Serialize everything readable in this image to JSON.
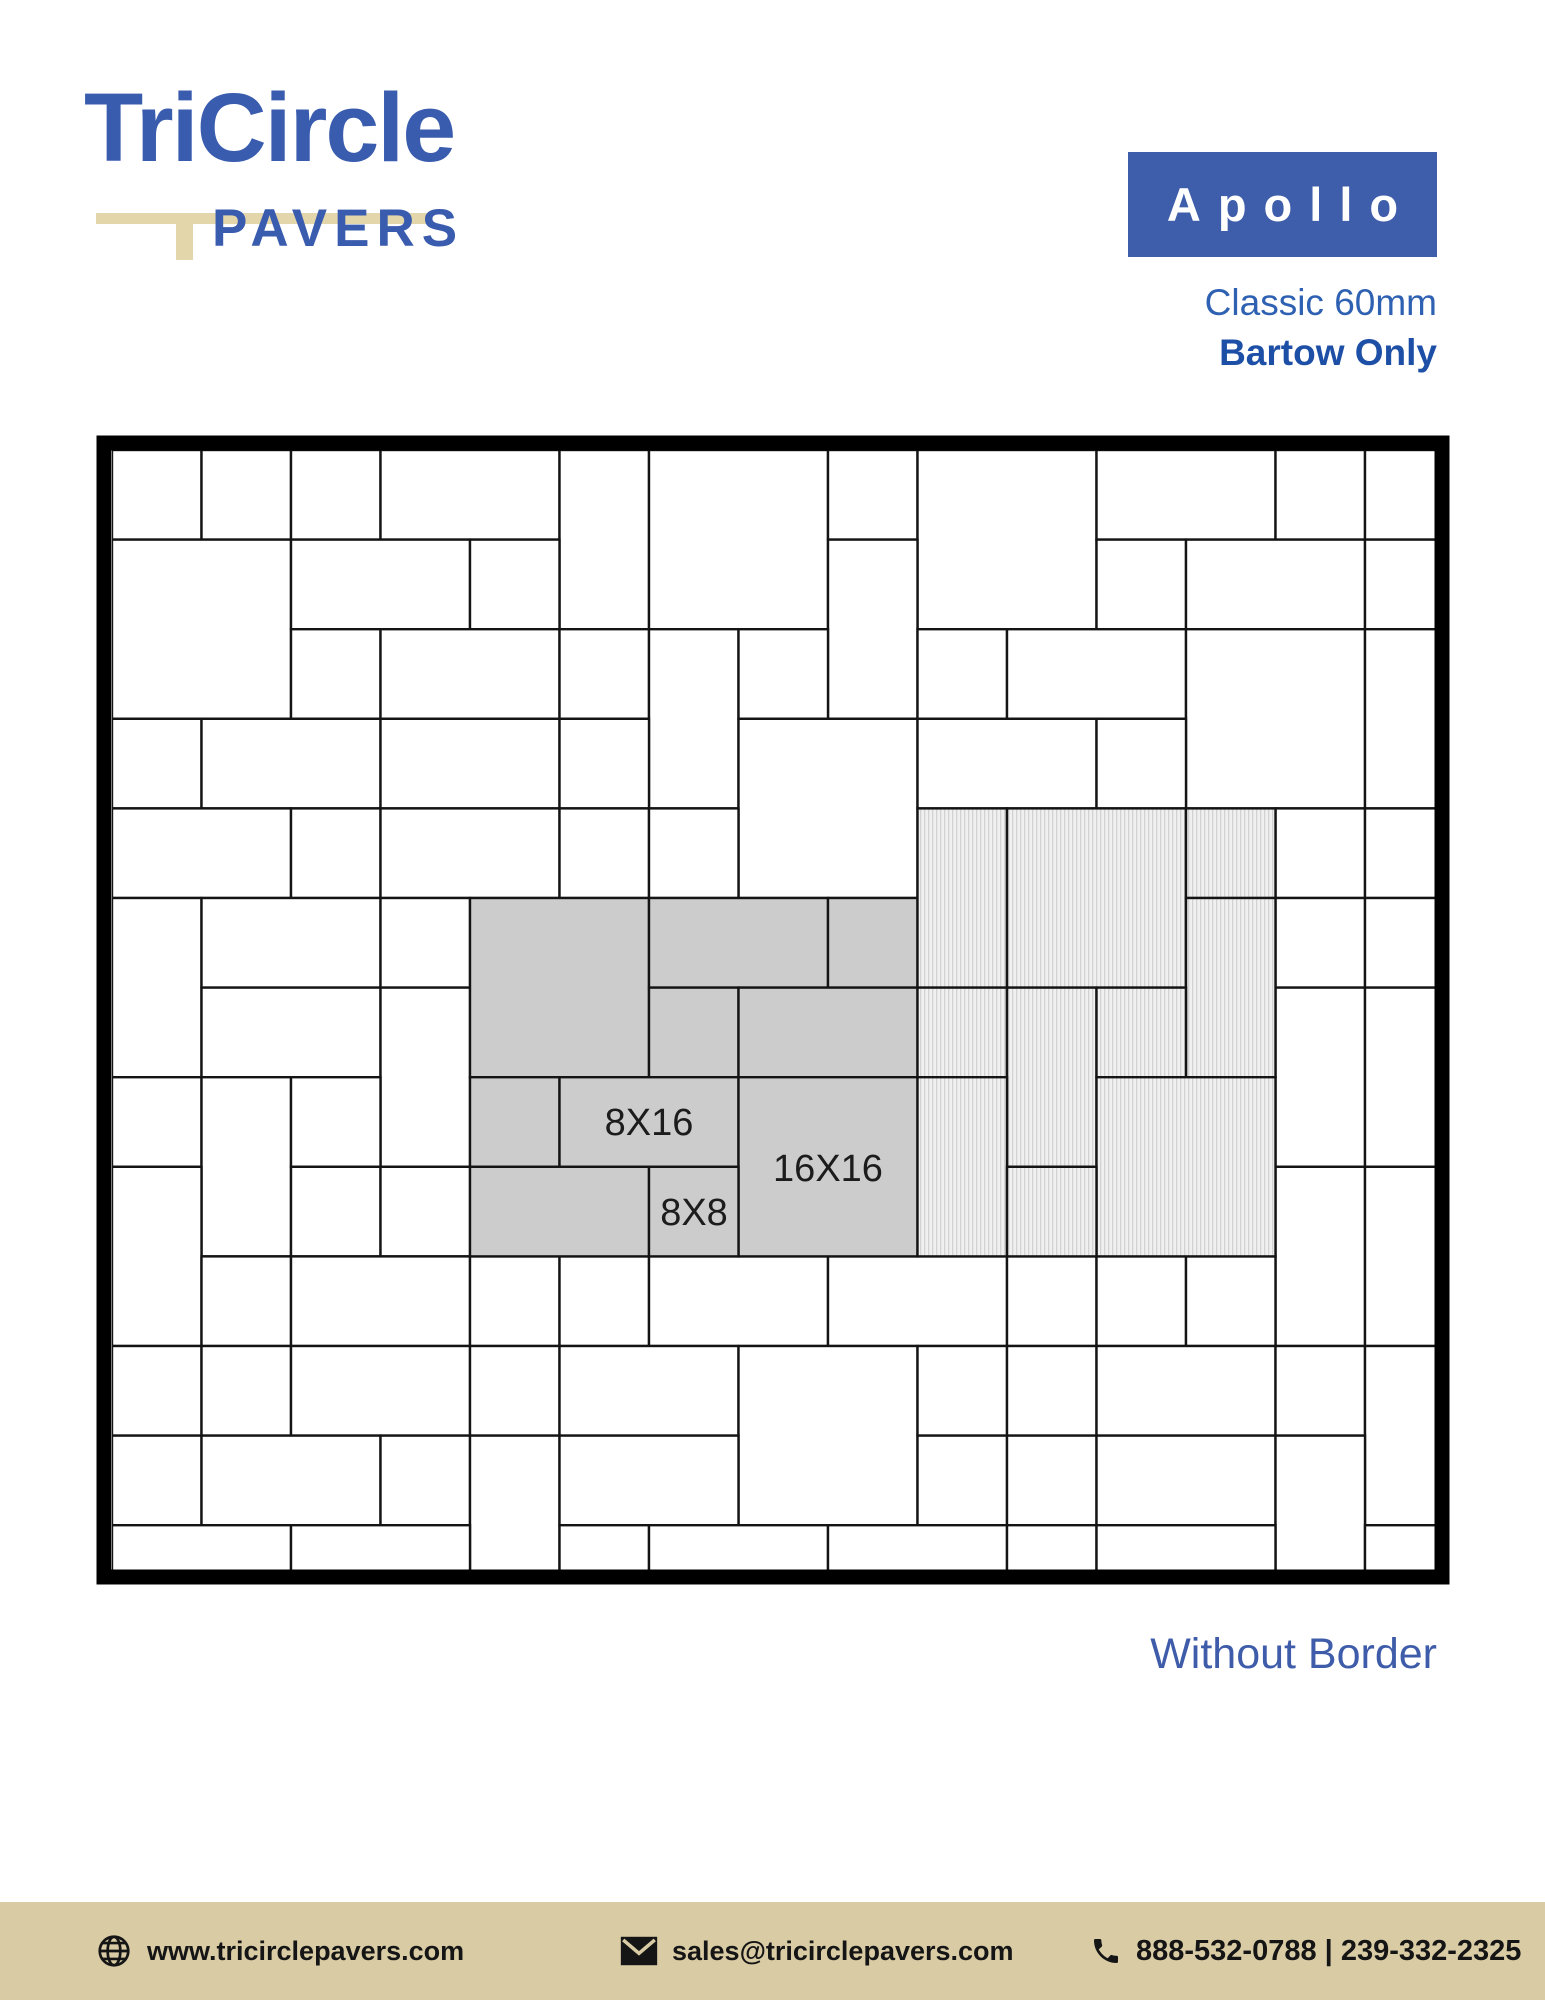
{
  "logo": {
    "title": "TriCircle",
    "subtitle": "PAVERS"
  },
  "product": {
    "name": "Apollo",
    "line1": "Classic 60mm",
    "line2": "Bartow Only"
  },
  "caption": "Without Border",
  "footer": {
    "website": "www.tricirclepavers.com",
    "email": "sales@tricirclepavers.com",
    "phone": "888-532-0788 | 239-332-2325"
  },
  "colors": {
    "brand_blue": "#3A5CAE",
    "badge_blue": "#3E5DAA",
    "classic_blue": "#2F61B2",
    "bartow_blue": "#1C4FA5",
    "caption_blue": "#3E5CA9",
    "tan": "#E3D6AB",
    "footer_tan": "#D9CCA5",
    "tile_white": "#ffffff",
    "tile_gray": "#cccccc",
    "hatch_base": "#f0f0f0",
    "hatch_line": "#d2d2d2",
    "line_black": "#141414"
  },
  "diagram": {
    "frame": {
      "x": 104,
      "y": 443,
      "w": 1338,
      "h": 1134,
      "stroke": 15
    },
    "grid": {
      "origin_x": 112,
      "origin_y": 450,
      "unit_x": 89.5,
      "unit_y": 89.6,
      "clip_x": 112,
      "clip_y": 450,
      "clip_w": 1323,
      "clip_h": 1120
    },
    "labels": [
      {
        "text": "8X16",
        "x": 649,
        "y": 1135
      },
      {
        "text": "16X16",
        "x": 828,
        "y": 1181
      },
      {
        "text": "8X8",
        "x": 694,
        "y": 1225
      }
    ],
    "tiles": [
      [
        0,
        0,
        1,
        1,
        "W"
      ],
      [
        1,
        0,
        1,
        1,
        "W"
      ],
      [
        2,
        0,
        1,
        1,
        "W"
      ],
      [
        3,
        0,
        2,
        1,
        "W"
      ],
      [
        5,
        0,
        1,
        2,
        "W"
      ],
      [
        6,
        0,
        2,
        2,
        "W"
      ],
      [
        8,
        0,
        1,
        1,
        "W"
      ],
      [
        9,
        0,
        2,
        2,
        "W"
      ],
      [
        11,
        0,
        2,
        1,
        "W"
      ],
      [
        13,
        0,
        1,
        1,
        "W"
      ],
      [
        14,
        0,
        1,
        1,
        "W"
      ],
      [
        0,
        1,
        2,
        2,
        "W"
      ],
      [
        2,
        1,
        2,
        1,
        "W"
      ],
      [
        4,
        1,
        1,
        1,
        "W"
      ],
      [
        8,
        1,
        1,
        2,
        "W"
      ],
      [
        11,
        1,
        1,
        1,
        "W"
      ],
      [
        12,
        1,
        2,
        1,
        "W"
      ],
      [
        14,
        1,
        1,
        1,
        "W"
      ],
      [
        2,
        2,
        1,
        1,
        "W"
      ],
      [
        3,
        2,
        2,
        1,
        "W"
      ],
      [
        5,
        2,
        1,
        1,
        "W"
      ],
      [
        6,
        2,
        1,
        2,
        "W"
      ],
      [
        7,
        2,
        1,
        1,
        "W"
      ],
      [
        9,
        2,
        1,
        1,
        "W"
      ],
      [
        10,
        2,
        2,
        1,
        "W"
      ],
      [
        12,
        2,
        2,
        2,
        "W"
      ],
      [
        14,
        2,
        1,
        2,
        "W"
      ],
      [
        0,
        3,
        1,
        1,
        "W"
      ],
      [
        1,
        3,
        2,
        1,
        "W"
      ],
      [
        3,
        3,
        2,
        1,
        "W"
      ],
      [
        5,
        3,
        1,
        1,
        "W"
      ],
      [
        7,
        3,
        2,
        2,
        "W"
      ],
      [
        9,
        3,
        2,
        1,
        "W"
      ],
      [
        11,
        3,
        1,
        1,
        "W"
      ],
      [
        0,
        4,
        2,
        1,
        "W"
      ],
      [
        2,
        4,
        1,
        1,
        "W"
      ],
      [
        3,
        4,
        2,
        1,
        "W"
      ],
      [
        5,
        4,
        1,
        1,
        "W"
      ],
      [
        6,
        4,
        1,
        1,
        "W"
      ],
      [
        13,
        4,
        1,
        1,
        "W"
      ],
      [
        14,
        4,
        1,
        1,
        "W"
      ],
      [
        0,
        5,
        1,
        2,
        "W"
      ],
      [
        1,
        5,
        2,
        1,
        "W"
      ],
      [
        3,
        5,
        1,
        1,
        "W"
      ],
      [
        13,
        5,
        1,
        1,
        "W"
      ],
      [
        14,
        5,
        1,
        1,
        "W"
      ],
      [
        1,
        6,
        2,
        1,
        "W"
      ],
      [
        3,
        6,
        1,
        2,
        "W"
      ],
      [
        13,
        6,
        1,
        2,
        "W"
      ],
      [
        14,
        6,
        1,
        2,
        "W"
      ],
      [
        0,
        7,
        1,
        1,
        "W"
      ],
      [
        1,
        7,
        1,
        2,
        "W"
      ],
      [
        2,
        7,
        1,
        1,
        "W"
      ],
      [
        0,
        8,
        1,
        2,
        "W"
      ],
      [
        2,
        8,
        1,
        1,
        "W"
      ],
      [
        3,
        8,
        1,
        1,
        "W"
      ],
      [
        13,
        8,
        1,
        2,
        "W"
      ],
      [
        14,
        8,
        1,
        2,
        "W"
      ],
      [
        1,
        9,
        1,
        1,
        "W"
      ],
      [
        2,
        9,
        2,
        1,
        "W"
      ],
      [
        4,
        9,
        1,
        1,
        "W"
      ],
      [
        5,
        9,
        1,
        1,
        "W"
      ],
      [
        6,
        9,
        2,
        1,
        "W"
      ],
      [
        8,
        9,
        2,
        1,
        "W"
      ],
      [
        10,
        9,
        1,
        1,
        "W"
      ],
      [
        11,
        9,
        1,
        1,
        "W"
      ],
      [
        12,
        9,
        1,
        1,
        "W"
      ],
      [
        0,
        10,
        1,
        1,
        "W"
      ],
      [
        1,
        10,
        1,
        1,
        "W"
      ],
      [
        2,
        10,
        2,
        1,
        "W"
      ],
      [
        4,
        10,
        1,
        1,
        "W"
      ],
      [
        5,
        10,
        2,
        1,
        "W"
      ],
      [
        7,
        10,
        2,
        2,
        "W"
      ],
      [
        9,
        10,
        1,
        1,
        "W"
      ],
      [
        10,
        10,
        1,
        1,
        "W"
      ],
      [
        11,
        10,
        2,
        1,
        "W"
      ],
      [
        13,
        10,
        1,
        1,
        "W"
      ],
      [
        14,
        10,
        1,
        2,
        "W"
      ],
      [
        0,
        11,
        1,
        1,
        "W"
      ],
      [
        1,
        11,
        2,
        1,
        "W"
      ],
      [
        3,
        11,
        1,
        1,
        "W"
      ],
      [
        4,
        11,
        1,
        2,
        "W"
      ],
      [
        5,
        11,
        2,
        1,
        "W"
      ],
      [
        9,
        11,
        1,
        1,
        "W"
      ],
      [
        10,
        11,
        1,
        1,
        "W"
      ],
      [
        11,
        11,
        2,
        1,
        "W"
      ],
      [
        13,
        11,
        1,
        2,
        "W"
      ],
      [
        0,
        12,
        2,
        1,
        "W"
      ],
      [
        2,
        12,
        2,
        1,
        "W"
      ],
      [
        5,
        12,
        1,
        1,
        "W"
      ],
      [
        6,
        12,
        2,
        1,
        "W"
      ],
      [
        8,
        12,
        2,
        1,
        "W"
      ],
      [
        10,
        12,
        1,
        1,
        "W"
      ],
      [
        11,
        12,
        2,
        1,
        "W"
      ],
      [
        14,
        12,
        1,
        1,
        "W"
      ],
      [
        4,
        5,
        2,
        2,
        "G"
      ],
      [
        6,
        5,
        2,
        1,
        "G"
      ],
      [
        8,
        5,
        1,
        1,
        "G"
      ],
      [
        6,
        6,
        1,
        1,
        "G"
      ],
      [
        7,
        6,
        2,
        1,
        "G"
      ],
      [
        4,
        7,
        1,
        1,
        "G"
      ],
      [
        5,
        7,
        2,
        1,
        "G"
      ],
      [
        7,
        7,
        2,
        2,
        "G"
      ],
      [
        4,
        8,
        2,
        1,
        "G"
      ],
      [
        6,
        8,
        1,
        1,
        "G"
      ],
      [
        9,
        4,
        1,
        2,
        "H"
      ],
      [
        10,
        4,
        2,
        2,
        "H"
      ],
      [
        12,
        4,
        1,
        1,
        "H"
      ],
      [
        12,
        5,
        1,
        2,
        "H"
      ],
      [
        9,
        6,
        1,
        1,
        "H"
      ],
      [
        10,
        6,
        1,
        2,
        "H"
      ],
      [
        11,
        6,
        1,
        1,
        "H"
      ],
      [
        9,
        7,
        1,
        2,
        "H"
      ],
      [
        11,
        7,
        2,
        2,
        "H"
      ],
      [
        10,
        8,
        1,
        1,
        "H"
      ]
    ]
  }
}
